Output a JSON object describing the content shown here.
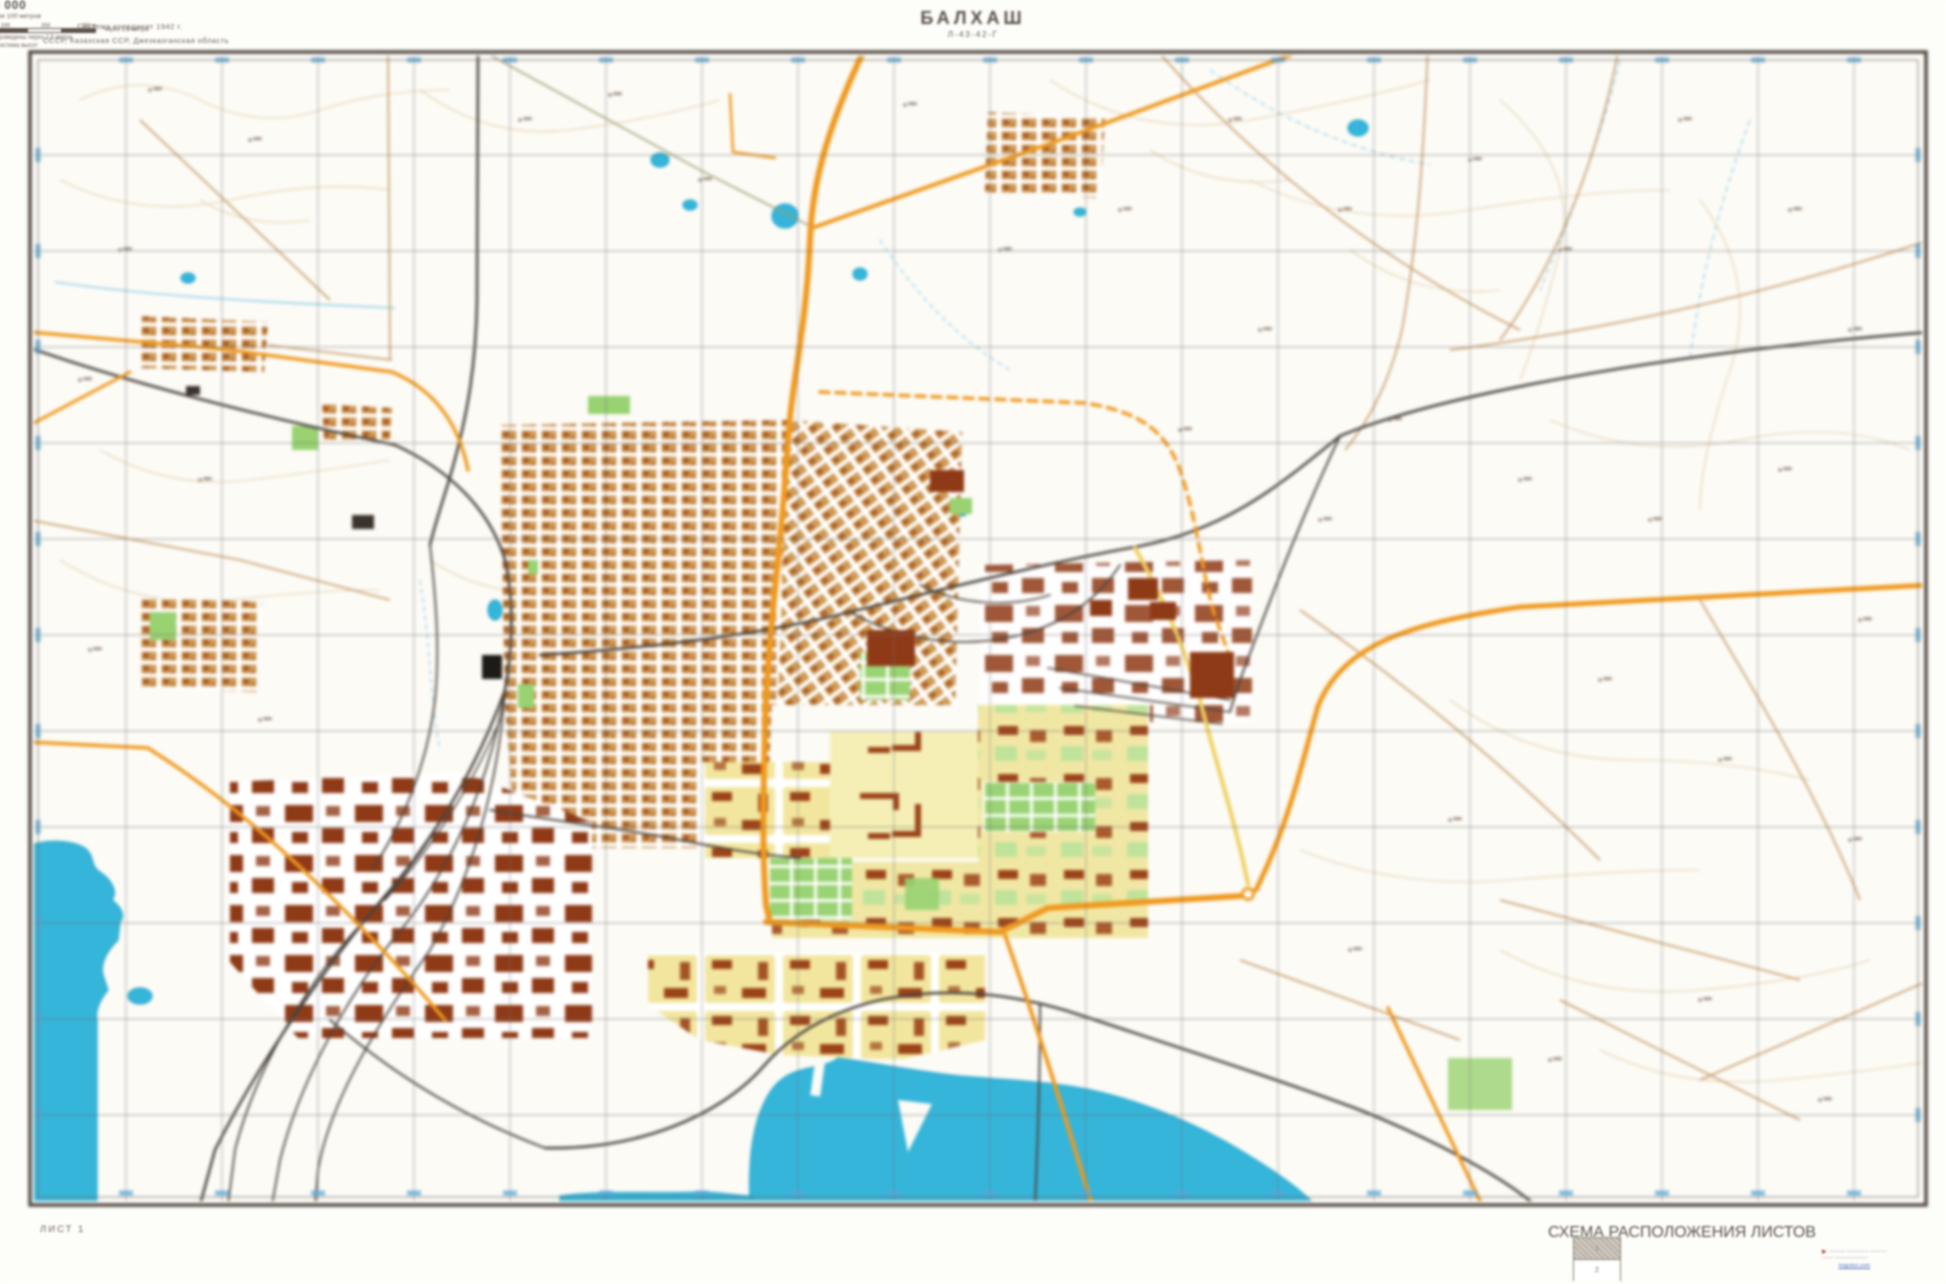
{
  "map": {
    "title": "БАЛХАШ",
    "sheet_code": "Л-43-42-Г",
    "top_left_line1": "Система координат 1942 г.",
    "top_left_line2": "СССР, Казахская ССР, Джезказганская область",
    "sheet_label": "ЛИСТ 1"
  },
  "scale_block": {
    "scale": "1:10 000",
    "note": "в 1 сантиметре 100 метров",
    "bar_labels": [
      "100",
      "0",
      "100",
      "200",
      "300 м"
    ],
    "flank_left": "Сплошные горизонтали",
    "flank_right": "через 2,5 метра",
    "below1": "Сплошные горизонтали проведены через 2,5 метра",
    "below2": "Балтийская система высот"
  },
  "scheme": {
    "title": "СХЕМА РАСПОЛОЖЕНИЯ ЛИСТОВ",
    "sheet1": "1",
    "sheet2": "2"
  },
  "watermark": {
    "arrow": "▸",
    "caption1": "——— ———— ———",
    "caption2": "—— ——————",
    "site": "mapstor.com"
  },
  "colors": {
    "paper": "#fcfbf6",
    "frame": "#4f463d",
    "grid": "#6f6f6f",
    "water": "#35b5da",
    "contour": "#e5d0ad",
    "road_major": "#f0991e",
    "road_dirt": "#c49661",
    "railway": "#4b443d",
    "block_tan": "#cf9a55",
    "block_yellow": "#f2e69e",
    "block_pale": "#f5efb6",
    "building_red": "#9c4318",
    "green": "#98d271",
    "label_blue": "#57a7d9"
  }
}
